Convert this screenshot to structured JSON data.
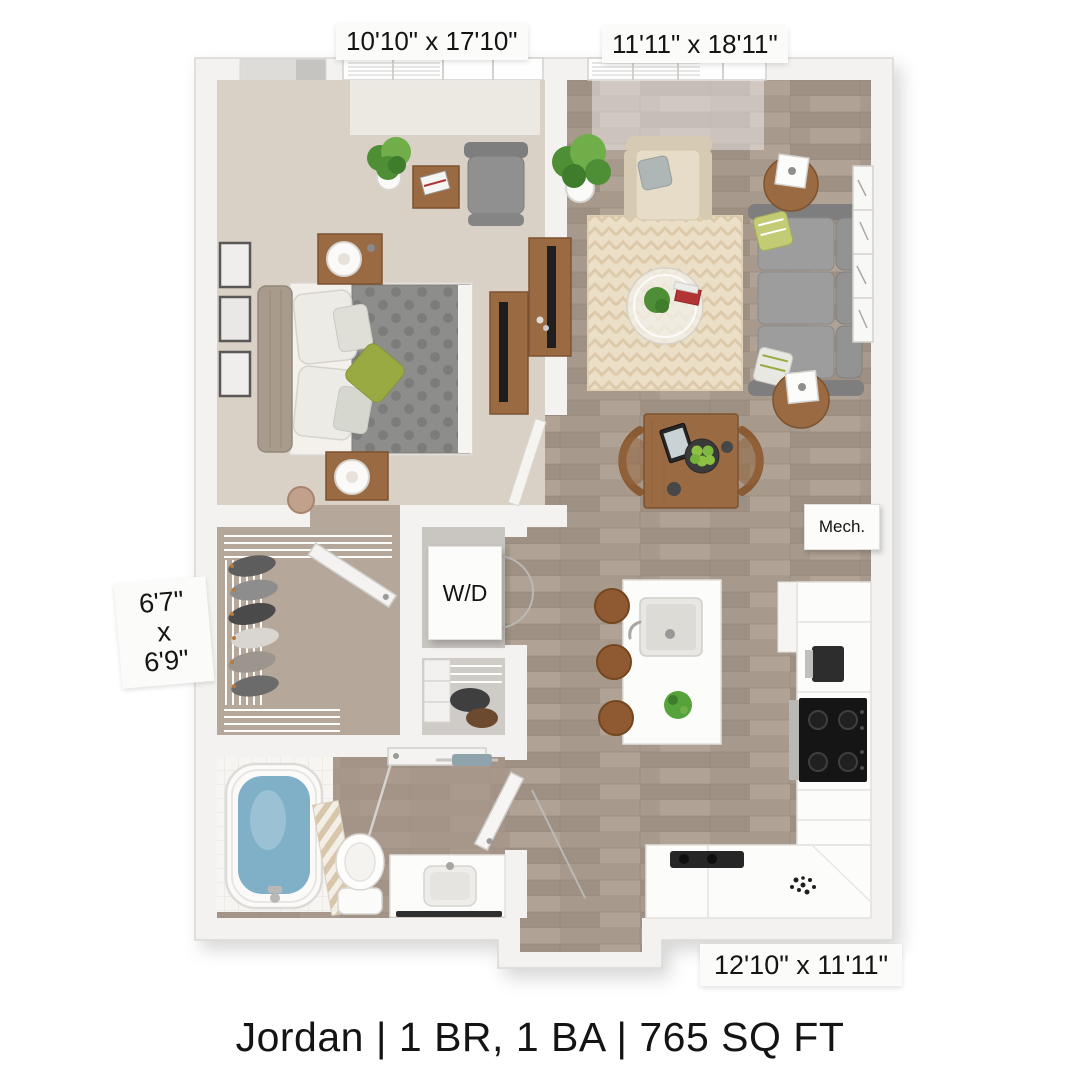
{
  "caption": "Jordan | 1 BR, 1 BA | 765 SQ FT",
  "dimension_labels": {
    "bedroom": "10'10\" x 17'10\"",
    "living_room": "11'11\" x 18'11\"",
    "walk_in_closet": {
      "line1": "6'7\"",
      "line2": "x",
      "line3": "6'9\""
    },
    "kitchen": "12'10\" x 11'11\""
  },
  "room_tags": {
    "washer_dryer": "W/D",
    "mechanical": "Mech."
  },
  "colors": {
    "wall": "#f3f2f0",
    "wall_edge": "#d9d7d3",
    "void": "#dedcd8",
    "void_dark": "#c6c4c0",
    "wood_floor": "#a79a8c",
    "wood_floor_dark": "#9e9082",
    "wood_floor_mid": "#b0a294",
    "carpet": "#d9d1c5",
    "closet_floor": "#b5a89b",
    "bath_floor": "#a59689",
    "tile": "#f6f5f2",
    "tile_line": "#e7e5e1",
    "rug": "#ecdfc8",
    "rug_stripe": "#d9c5a2",
    "sofa": "#939393",
    "sofa_dark": "#7e7e7e",
    "cushion": "#9d9d9d",
    "chair_beige": "#e6dcc7",
    "chair_beige_dark": "#d7cab2",
    "wood_furniture": "#9a6a43",
    "wood_furniture_dark": "#7c5330",
    "stool": "#8f5a32",
    "duvet": "#8d8d8b",
    "duvet_dot": "#7c7c7a",
    "bed_sheet": "#f4f1ec",
    "headboard": "#a89b8c",
    "pillow_white": "#ecebe5",
    "accent_green": "#9aaa42",
    "plant_green": "#4e8f35",
    "plant_green_light": "#6fae49",
    "tub_water": "#7fb0c8",
    "fixture_white": "#fcfcfb",
    "fixture_edge": "#e2e0dc",
    "appliance_dark": "#1a1a1a",
    "stainless": "#bab8b4",
    "curtain_stripe": "#d8c6ab",
    "curtain_bg": "#f4efe6",
    "label_bg": "#fbfbfa",
    "text": "#141414"
  }
}
